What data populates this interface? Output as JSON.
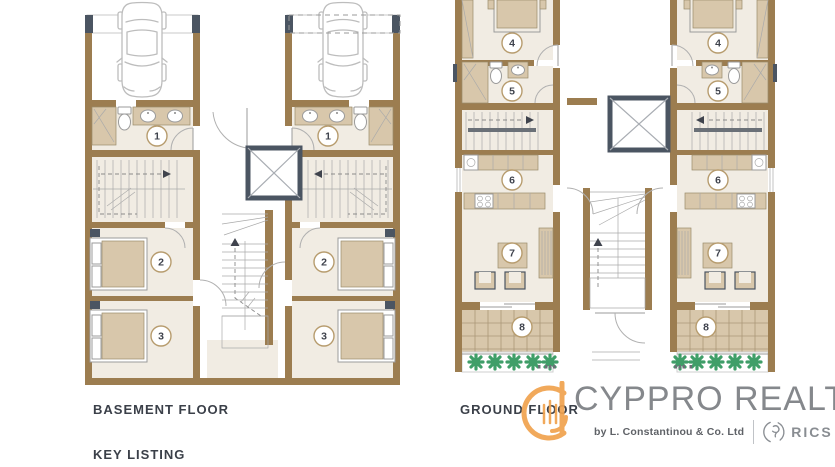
{
  "plans": {
    "basement": {
      "title": "BASEMENT FLOOR",
      "room_numbers": [
        "1",
        "2",
        "3"
      ]
    },
    "ground": {
      "title": "GROUND FLOOR",
      "room_numbers": [
        "4",
        "5",
        "6",
        "7",
        "8"
      ]
    }
  },
  "legend": {
    "title": "KEY LISTING"
  },
  "watermark": {
    "brand": "CYPPRO REALTY",
    "byline": "by L. Constantinou & Co. Ltd",
    "certification": "RICS"
  },
  "colors": {
    "wall": "#9c7d50",
    "floor": "#f1ece3",
    "tan": "#d8c7ab",
    "dark": "#4b5562",
    "plant": "#3f9e68",
    "ring": "#b79c6e",
    "label": "#3f434d",
    "title": "#3b4049",
    "logoorange": "#f0a24e",
    "logogray": "#85888c"
  }
}
